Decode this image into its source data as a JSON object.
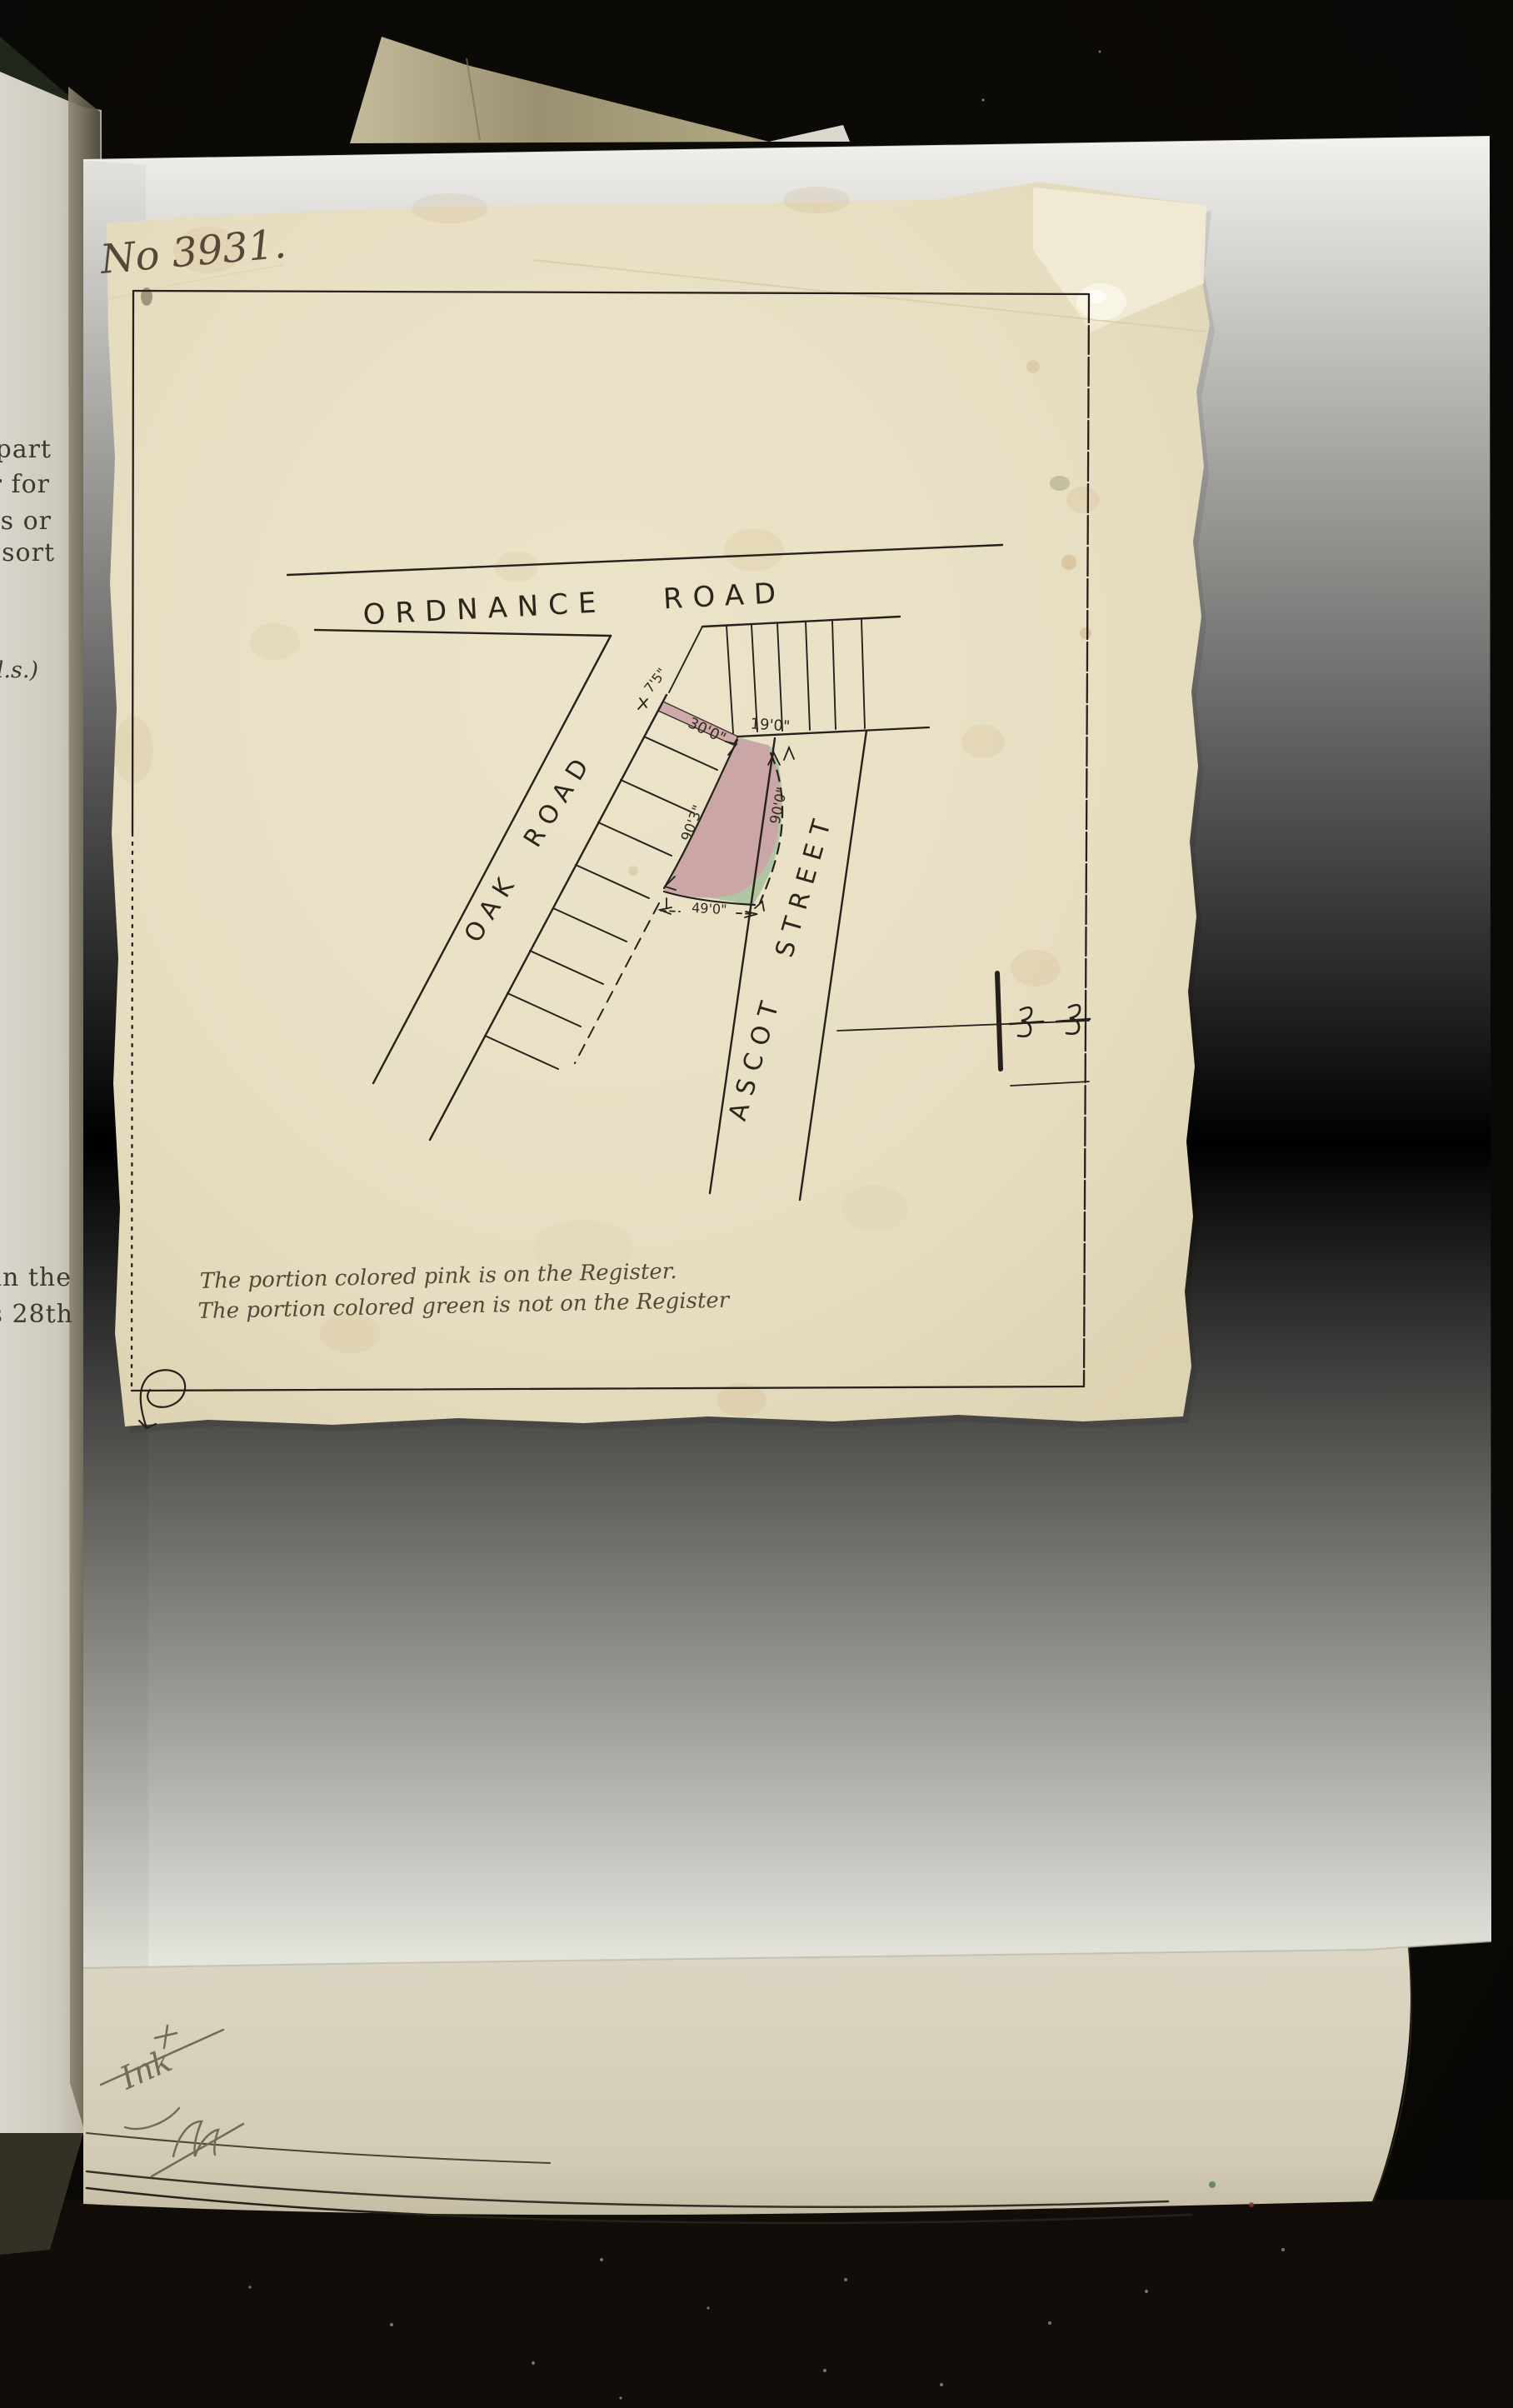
{
  "scan": {
    "plan": {
      "number_label": "No 3931.",
      "road_top": "ORDNANCE ROAD",
      "road_left": "OAK ROAD",
      "road_right": "ASCOT STREET",
      "dim_top_frontage": "7'5\"",
      "dim_strip": "30'0\"",
      "dim_street_gap": "19'0\"",
      "dim_west_boundary": "90'3\"",
      "dim_east_boundary": "90'0\"",
      "dim_bottom": "49'0\"",
      "caption_line1": "The portion colored pink is on the Register.",
      "caption_line2": "The portion colored green is not on the Register",
      "color_pink": "#cda6a6",
      "color_green": "#a3c29b",
      "ink_color": "#26211a"
    },
    "printed_page_fragments": [
      "part",
      "r  for",
      "es or",
      "resort",
      "l.s.)",
      "in  the",
      "his 28th"
    ],
    "pencil": {
      "cross": "+",
      "word": "Ink"
    }
  }
}
